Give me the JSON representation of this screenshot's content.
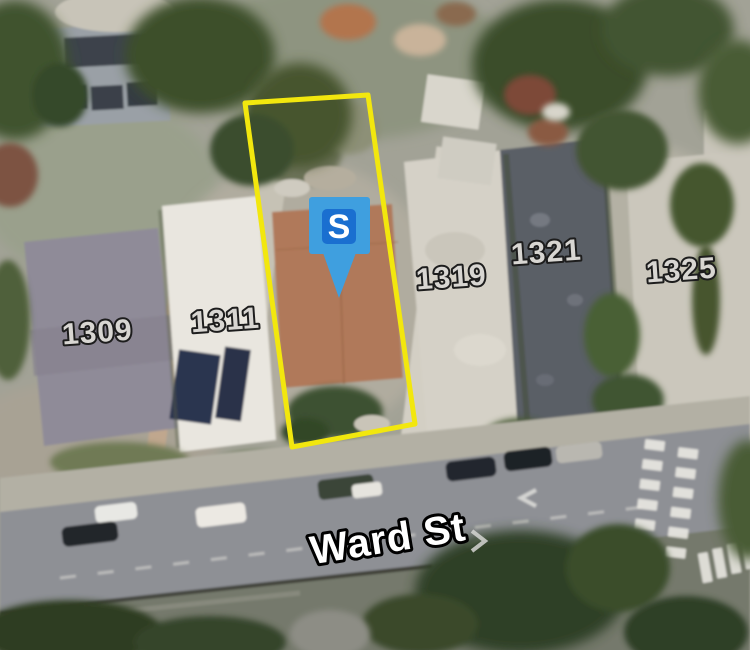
{
  "map": {
    "street": {
      "name": "Ward St"
    },
    "marker": {
      "label": "S",
      "outer_color": "#3f9fdf",
      "inner_color": "#1a6fd0"
    },
    "parcel": {
      "outline_color": "#f2e70e"
    },
    "addresses": [
      {
        "label": "1309"
      },
      {
        "label": "1311"
      },
      {
        "label": "1319"
      },
      {
        "label": "1321"
      },
      {
        "label": "1325"
      }
    ]
  }
}
